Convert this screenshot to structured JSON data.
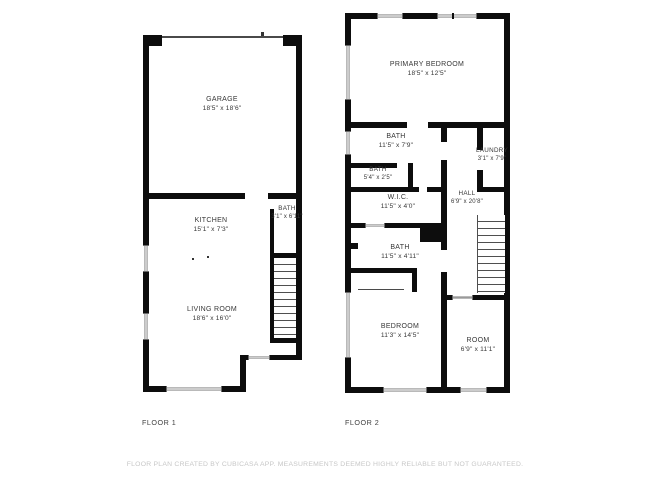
{
  "page": {
    "footer": "FLOOR PLAN CREATED BY CUBICASA APP. MEASUREMENTS DEEMED HIGHLY RELIABLE BUT NOT GUARANTEED."
  },
  "colors": {
    "wall": "#0d0d0d",
    "label_text": "#373737",
    "footer_text": "#c7c7c7",
    "background": "#ffffff"
  },
  "floor1": {
    "label": "FLOOR 1",
    "rooms": {
      "garage": {
        "name": "GARAGE",
        "dims": "18'5\" x 18'6\""
      },
      "kitchen": {
        "name": "KITCHEN",
        "dims": "15'1\" x 7'3\""
      },
      "bath": {
        "name": "BATH",
        "dims": "3'1\" x 6'11\""
      },
      "living_room": {
        "name": "LIVING ROOM",
        "dims": "18'6\" x 16'0\""
      }
    }
  },
  "floor2": {
    "label": "FLOOR 2",
    "rooms": {
      "primary_bedroom": {
        "name": "PRIMARY BEDROOM",
        "dims": "18'5\" x 12'5\""
      },
      "bath_upper": {
        "name": "BATH",
        "dims": "11'5\" x 7'9\""
      },
      "bath_small": {
        "name": "BATH",
        "dims": "5'4\" x 2'5\""
      },
      "laundry": {
        "name": "LAUNDRY",
        "dims": "3'1\" x 7'9\""
      },
      "wic": {
        "name": "W.I.C.",
        "dims": "11'5\" x 4'0\""
      },
      "hall": {
        "name": "HALL",
        "dims": "6'9\" x 20'8\""
      },
      "bath_lower": {
        "name": "BATH",
        "dims": "11'5\" x 4'11\""
      },
      "bedroom": {
        "name": "BEDROOM",
        "dims": "11'3\" x 14'5\""
      },
      "room": {
        "name": "ROOM",
        "dims": "6'9\" x 11'1\""
      }
    }
  }
}
